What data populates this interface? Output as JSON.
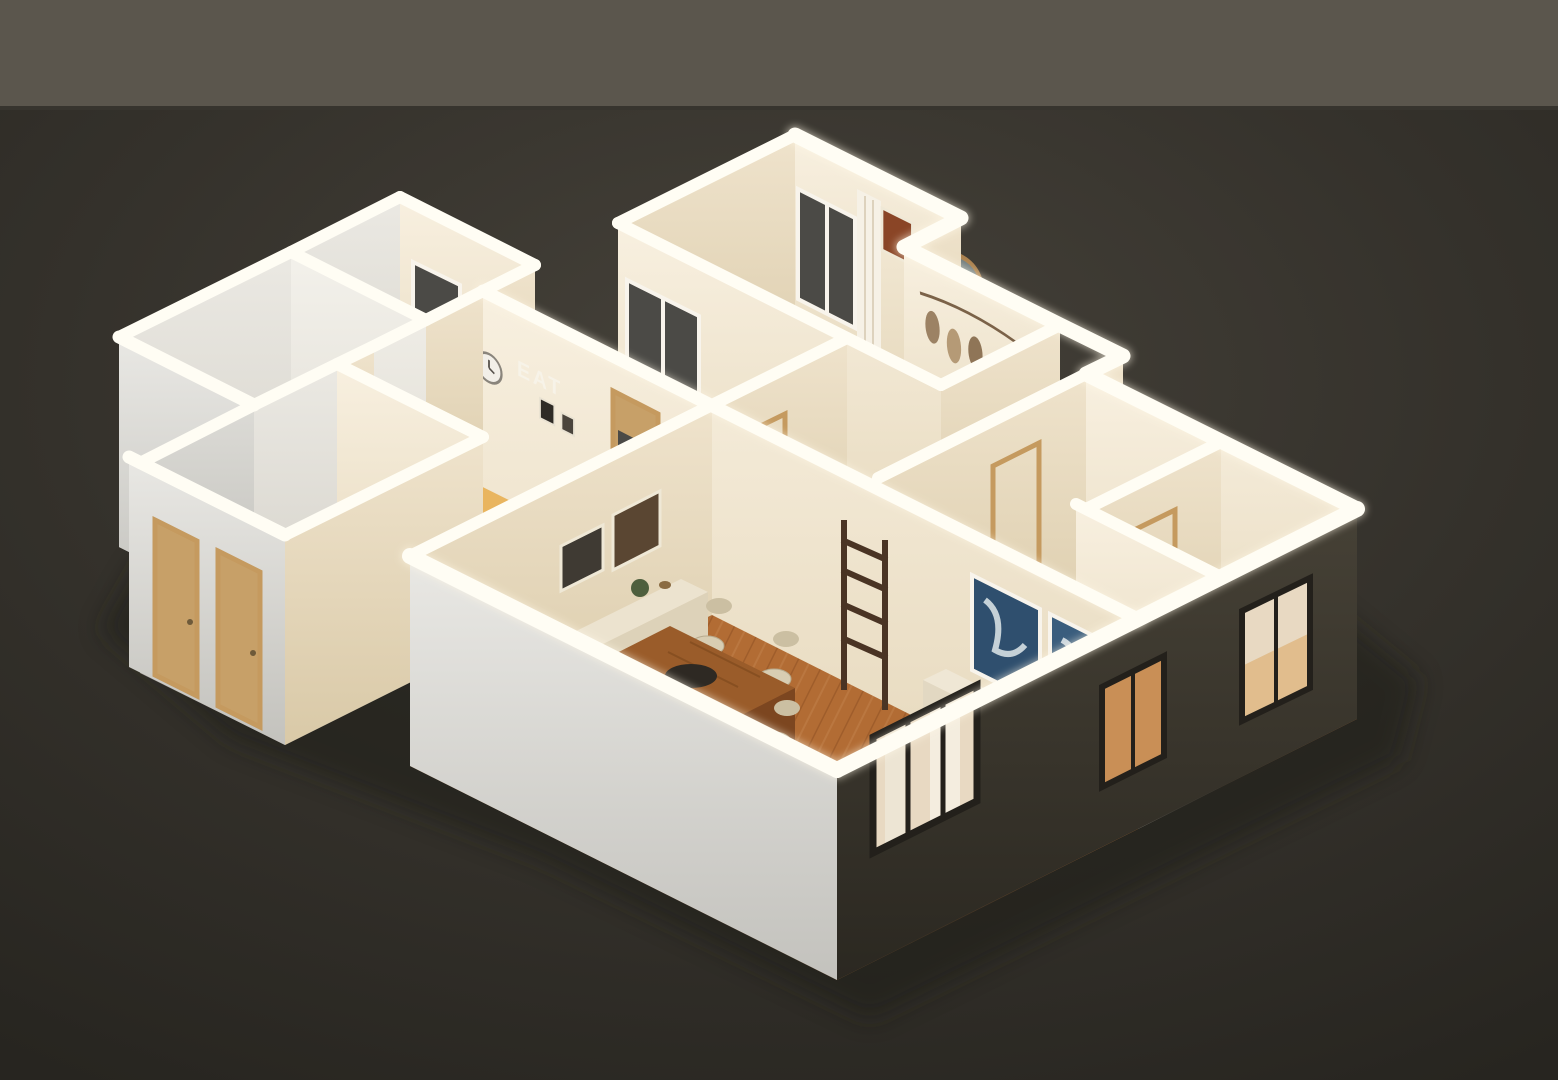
{
  "scene": {
    "style": "isometric 3D cutaway dollhouse render of a furnished apartment",
    "lighting": "warm interior glow with bright white cut wall tops, dark dusk backdrop",
    "wall_text": "EAT"
  },
  "colors": {
    "backdrop_wall": "#5b564d",
    "backdrop_seam": "#37342e",
    "ground": "#37342d",
    "shadow": "#1f1d18",
    "wall_top": "#fffdf4",
    "face_cream_sw": "#f5ecd9",
    "face_cream_se": "#ebdfc6",
    "exterior_white": "#dcdbd6",
    "facade_dark": "#39352c",
    "floor_wood": "#b26c34",
    "floor_tile": "#a8a29a",
    "floor_white": "#e9e6df",
    "floor_cream": "#ddd5c4",
    "counter_wood": "#e9b55f",
    "counter_side": "#c98f3b",
    "door_tan": "#c7a068",
    "glass_dark": "#4b4a46",
    "window_lit": "#e8d9c2",
    "window_warm": "#c98f56",
    "curtain": "#f6f1e6",
    "art_blue_1": "#2f4f6e",
    "art_blue_2": "#3a5d7d",
    "art_rust_1": "#8a4526",
    "art_rust_2": "#a65b2d",
    "sofa": "#e7dec9",
    "cushion": "#cbb89a",
    "table_wood": "#9a5c2a",
    "chair": "#d8cdb2",
    "bowl_black": "#2e2923",
    "rug": "#d8cfbc",
    "tray_gold": "#c8a04e",
    "plant_green": "#4e5f3d",
    "mirror_frame": "#c09055",
    "letters_white": "#f7f3e8",
    "clock_face": "#f2efe8",
    "toilet_white": "#f2f1ed"
  },
  "rooms": [
    {
      "name": "master-bedroom",
      "furnishings": [
        "double bed with pillows",
        "leaf garland wall hanging",
        "arched floor mirror",
        "potted plant",
        "two rust framed artworks",
        "curtained window",
        "bench"
      ]
    },
    {
      "name": "bedroom-2",
      "furnishings": []
    },
    {
      "name": "bedroom-3",
      "furnishings": []
    },
    {
      "name": "hallway",
      "furnishings": [
        "wood door frames"
      ]
    },
    {
      "name": "kitchen",
      "furnishings": [
        "wooden bar counter",
        "EAT wall letters",
        "wall clock",
        "small picture frames",
        "glazed tan door"
      ]
    },
    {
      "name": "utility-room",
      "furnishings": [
        "two dark windows"
      ]
    },
    {
      "name": "bathroom",
      "furnishings": [
        "bathtub",
        "toilet"
      ]
    },
    {
      "name": "entry",
      "furnishings": [
        "two tan exterior doors"
      ]
    },
    {
      "name": "living-dining-room",
      "furnishings": [
        "cream sofa with cushions",
        "two blue abstract artworks",
        "coffee table with round gold tray",
        "area rug",
        "wooden dining table with black bowl",
        "six cream chairs",
        "sideboard with decor",
        "ladder shelf",
        "framed pictures",
        "potted plants"
      ]
    }
  ],
  "exterior": {
    "windows": [
      "three-pane lit window with curtains",
      "single warm window",
      "two-pane lit window"
    ],
    "doors": [
      "two tan entry doors"
    ]
  }
}
